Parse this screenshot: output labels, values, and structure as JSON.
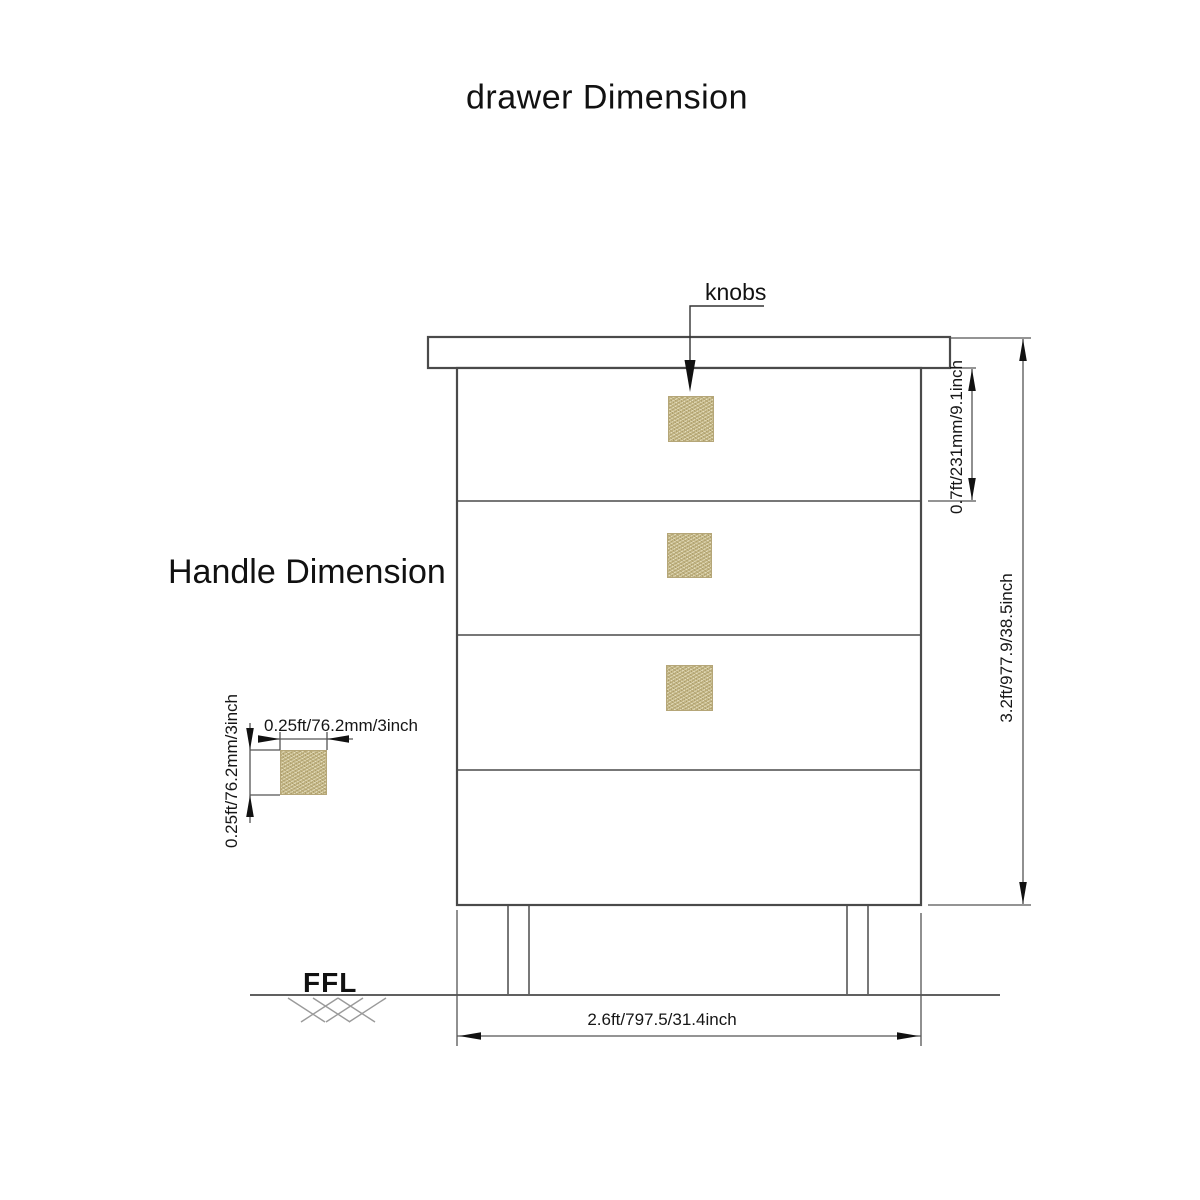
{
  "page": {
    "title": "drawer Dimension"
  },
  "sections": {
    "handle_title": "Handle Dimension"
  },
  "callouts": {
    "knobs": "knobs",
    "ffl": "FFL"
  },
  "dimensions": {
    "top_drawer_height": "0.7ft/231mm/9.1inch",
    "overall_height": "3.2ft/977.9/38.5inch",
    "overall_width": "2.6ft/797.5/31.4inch",
    "handle_width": "0.25ft/76.2mm/3inch",
    "handle_height": "0.25ft/76.2mm/3inch"
  },
  "colors": {
    "outline": "#4a4a4a",
    "dimension_line": "#555555",
    "hatch": "#9a9a9a",
    "knob_fill": "#c9bc8c",
    "text": "#111111"
  }
}
